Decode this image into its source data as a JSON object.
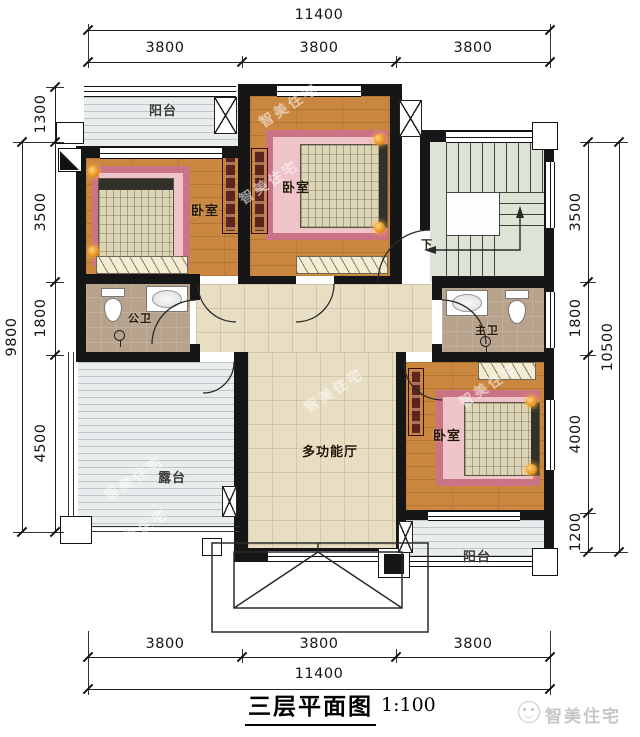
{
  "title_block": {
    "title": "三层平面图",
    "scale": "1:100"
  },
  "brand": {
    "name": "智美住宅"
  },
  "watermark": {
    "text": "智美住宅"
  },
  "dimensions": {
    "top": {
      "total": "11400",
      "segments": [
        "3800",
        "3800",
        "3800"
      ]
    },
    "bottom": {
      "total": "11400",
      "segments": [
        "3800",
        "3800",
        "3800"
      ]
    },
    "left": {
      "total": "9800",
      "segments": [
        "1300",
        "3500",
        "1800",
        "4500"
      ]
    },
    "right": {
      "total": "10500",
      "segments": [
        "3500",
        "1800",
        "4000",
        "1200"
      ]
    }
  },
  "rooms": {
    "balcony_top": "阳台",
    "bedroom_left": "卧室",
    "bedroom_middle": "卧室",
    "bedroom_bottom_right": "卧室",
    "bath_public": "公卫",
    "bath_master": "主卫",
    "hall": "多功能厅",
    "terrace": "露台",
    "balcony_bottom": "阳台",
    "stair_direction": "下"
  }
}
